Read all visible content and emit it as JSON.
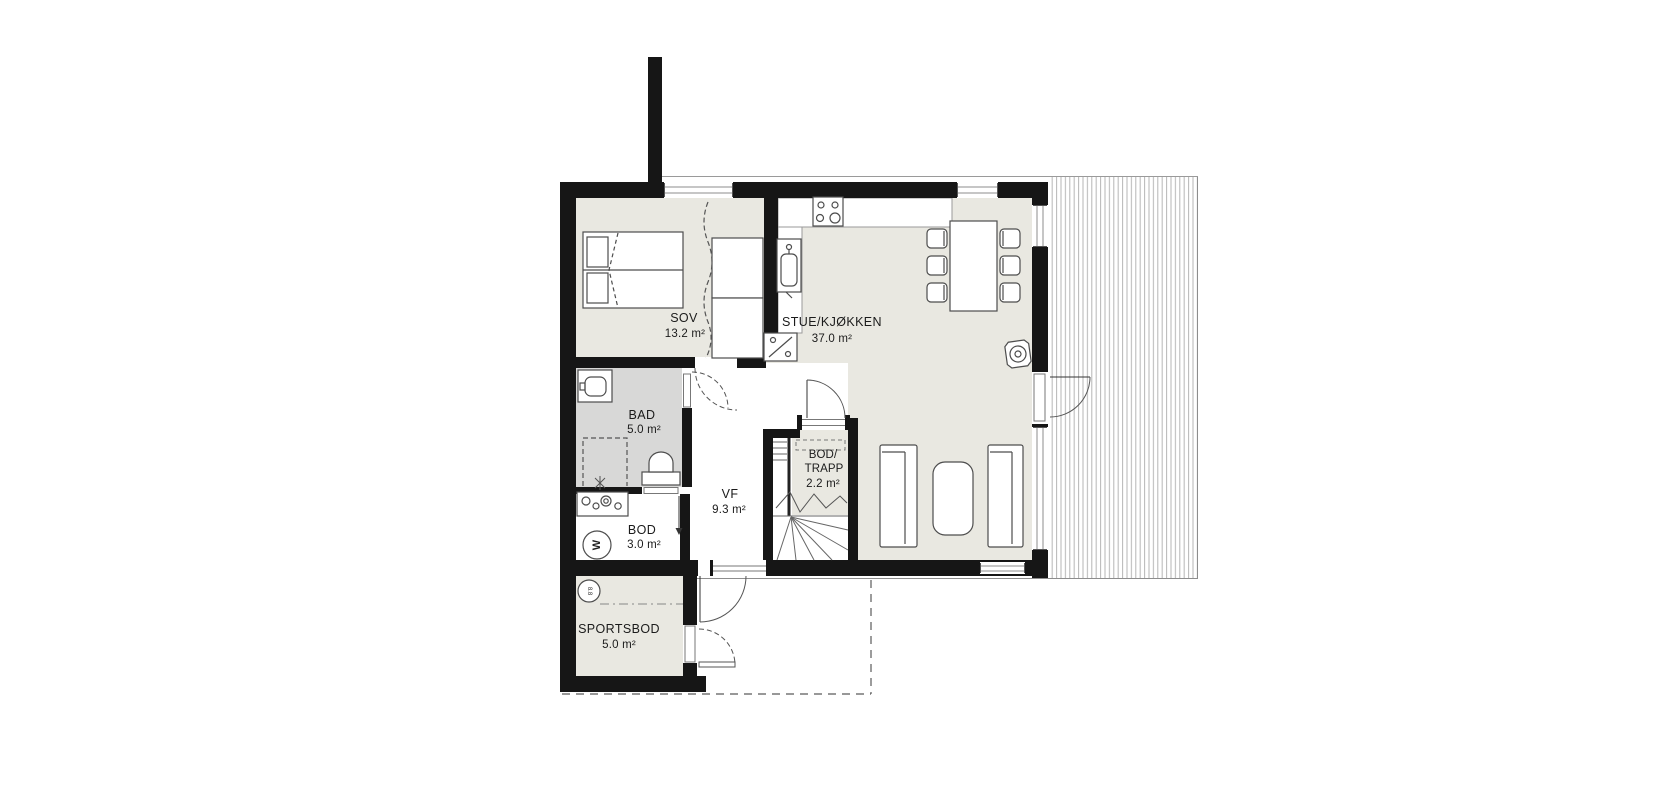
{
  "document": {
    "type": "floor-plan",
    "background": "#ffffff"
  },
  "colors": {
    "wall": "#161616",
    "floor": "#e9e8e1",
    "bathroom_floor": "#d8d8d7",
    "white_floor": "#ffffff",
    "furniture_stroke": "#4d4d4d",
    "frame_stroke": "#8d8d8d",
    "deck_line": "#b5b5b5",
    "dashed_line": "#5a5a5a",
    "label_text": "#1b1b1b"
  },
  "rooms": [
    {
      "id": "sov",
      "name": "SOV",
      "area": "13.2 m²"
    },
    {
      "id": "stue",
      "name": "STUE/KJØKKEN",
      "area": "37.0 m²"
    },
    {
      "id": "bad",
      "name": "BAD",
      "area": "5.0 m²"
    },
    {
      "id": "vf",
      "name": "VF",
      "area": "9.3 m²"
    },
    {
      "id": "bod_trapp",
      "name": "BOD/",
      "name2": "TRAPP",
      "area": "2.2 m²"
    },
    {
      "id": "bod",
      "name": "BOD",
      "area": "3.0 m²"
    },
    {
      "id": "sportsbod",
      "name": "SPORTSBOD",
      "area": "5.0 m²"
    }
  ],
  "fixtures": {
    "washing_machine_label": "W",
    "sportsbod_badge": "8.8"
  },
  "icons": {
    "stove": "cooktop-4-burners-icon",
    "kitchen_sink": "kitchen-sink-icon",
    "tall_cabinet": "tall-cabinet-diagonal-icon",
    "toilet": "toilet-icon",
    "washbasin": "washbasin-icon",
    "shower": "shower-dashed-icon",
    "laundry_sink": "laundry-counter-icon",
    "washing_machine": "washing-machine-icon",
    "wood_stove": "wood-stove-icon",
    "bed": "double-bed-icon",
    "wardrobe": "wardrobe-icon",
    "dining_table": "dining-table-icon",
    "chairs": "dining-chair-icon",
    "sofas": "sofa-icon",
    "coffee_table": "coffee-table-icon",
    "stairs": "winder-staircase-icon",
    "deck": "terrace-decking"
  }
}
